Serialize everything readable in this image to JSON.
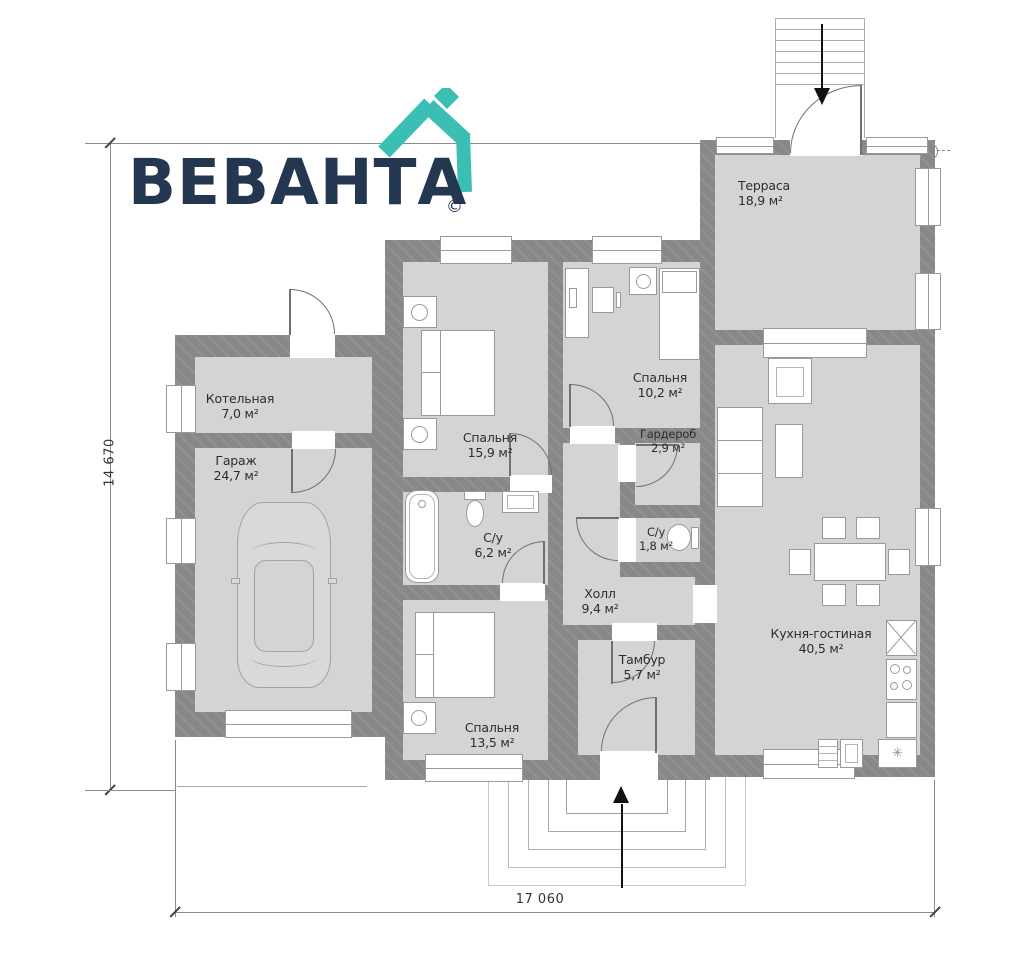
{
  "logo": {
    "brand": "ВЕВАНТА",
    "copyright": "©"
  },
  "dimensions": {
    "width": "17 060",
    "height": "14 670"
  },
  "rooms": [
    {
      "name": "Терраса",
      "area": "18,9 м²"
    },
    {
      "name": "Кухня-гостиная",
      "area": "40,5 м²"
    },
    {
      "name": "Котельная",
      "area": "7,0 м²"
    },
    {
      "name": "Гараж",
      "area": "24,7 м²"
    },
    {
      "name": "Спальня",
      "area": "15,9 м²"
    },
    {
      "name": "Спальня",
      "area": "10,2 м²"
    },
    {
      "name": "Гардероб",
      "area": "2,9 м²"
    },
    {
      "name": "С/у",
      "area": "6,2 м²"
    },
    {
      "name": "С/у",
      "area": "1,8 м²"
    },
    {
      "name": "Холл",
      "area": "9,4 м²"
    },
    {
      "name": "Тамбур",
      "area": "5,7 м²"
    },
    {
      "name": "Спальня",
      "area": "13,5 м²"
    }
  ],
  "icons": {
    "sink_star": "✳"
  },
  "colors": {
    "wall": "#8c8c8c",
    "floor": "#d4d4d4",
    "brand_navy": "#233750",
    "brand_teal": "#3bbfb4"
  }
}
